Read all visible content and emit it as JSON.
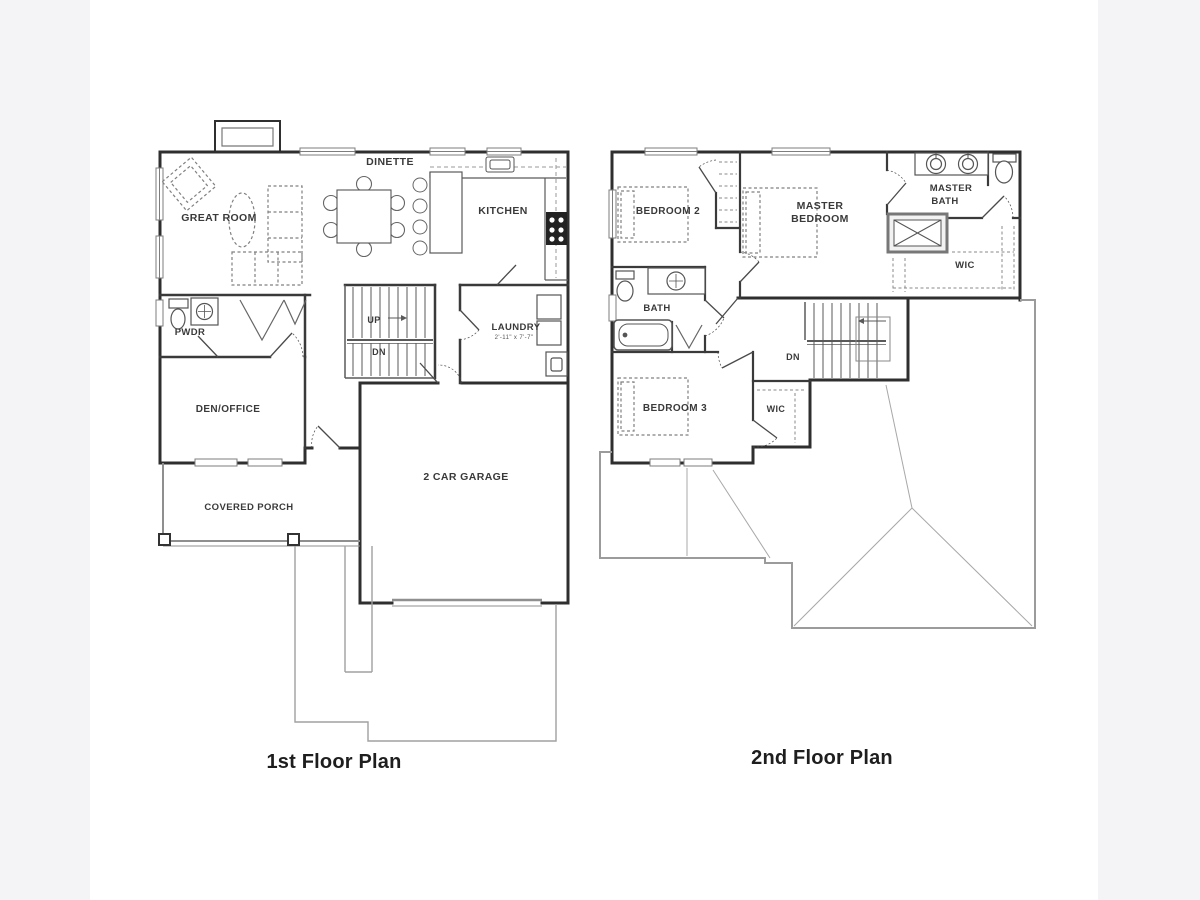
{
  "page": {
    "background_color": "#f4f3f6",
    "canvas_color": "#ffffff"
  },
  "colors": {
    "wall": "#2f2f2f",
    "fixture": "#555555",
    "dash": "#808080",
    "roof": "#9b9b9b",
    "site": "#a0a0a0",
    "text": "#3a3a3a"
  },
  "plans": {
    "first": {
      "caption": "1st Floor Plan",
      "rooms": {
        "great_room": "GREAT ROOM",
        "dinette": "DINETTE",
        "kitchen": "KITCHEN",
        "pwdr": "PWDR",
        "stairs_up": "UP",
        "stairs_dn": "DN",
        "laundry": "LAUNDRY",
        "laundry_dims": "2'-11\" x 7'-7\"",
        "den_office": "DEN/OFFICE",
        "covered_porch": "COVERED PORCH",
        "garage": "2 CAR GARAGE"
      }
    },
    "second": {
      "caption": "2nd Floor Plan",
      "rooms": {
        "bedroom2": "BEDROOM 2",
        "master_bedroom_line1": "MASTER",
        "master_bedroom_line2": "BEDROOM",
        "master_bath_line1": "MASTER",
        "master_bath_line2": "BATH",
        "wic_master": "WIC",
        "bath": "BATH",
        "stairs_dn": "DN",
        "bedroom3": "BEDROOM 3",
        "wic_bedroom3": "WIC"
      }
    }
  }
}
